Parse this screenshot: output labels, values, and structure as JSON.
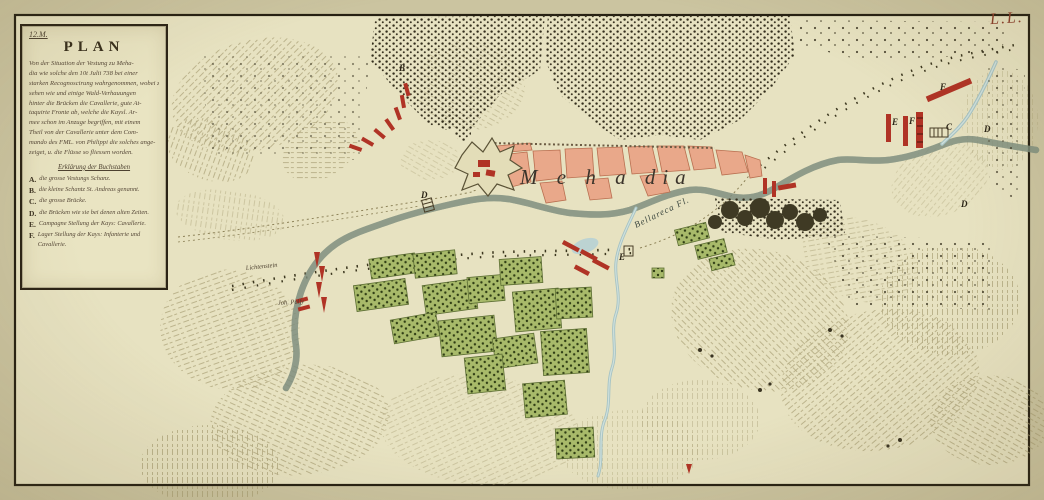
{
  "frame": {
    "corner_mark": "L.L."
  },
  "cartouche": {
    "catalog": "12.M.",
    "title": "PLAN",
    "body_lines": [
      "Von der Situation der Vestung zu Meha-",
      "dia wie solche den 10t Julii 738 bei einer",
      "starken Recognoscirung wahrgenommen, wobei zu",
      "sehen wie und einige Wald-Verhauungen",
      "hinter die Brücken die Cavallerie, gute At-",
      "taquirte Fronte ab, welche die Kaysl. Ar-",
      "mee schon im Anzuge begriffen, mit einem",
      "Theil von der Cavallerie unter dem Com-",
      "mando des FML. von Philippi die solches ange-",
      "zeiget, u. die Flüsse so fliessen worden."
    ],
    "legend_heading": "Erklärung der Buchstaben",
    "legend": [
      {
        "key": "A.",
        "text": "die grosse Vestungs Schanz."
      },
      {
        "key": "B.",
        "text": "die kleine Schantz St. Andreas genannt."
      },
      {
        "key": "C.",
        "text": "die grosse Brücke."
      },
      {
        "key": "D.",
        "text": "die Brücken wie sie bei denen alten Zeiten."
      },
      {
        "key": "E.",
        "text": "Campagne Stellung der Kays: Cavallerie."
      },
      {
        "key": "F.",
        "text": "Lager Stellung der Kays: Infanterie und Cavallerie."
      }
    ]
  },
  "map_labels": {
    "town": "M e h a dia",
    "river": "Bellareca Fl.",
    "regiment_1": "Lichtenstein",
    "regiment_2": "Joh. Palfy",
    "letters": [
      {
        "char": "B",
        "x": 399,
        "y": 71
      },
      {
        "char": "D",
        "x": 421,
        "y": 198
      },
      {
        "char": "E",
        "x": 619,
        "y": 260
      },
      {
        "char": "F",
        "x": 940,
        "y": 90
      },
      {
        "char": "E",
        "x": 892,
        "y": 125
      },
      {
        "char": "F",
        "x": 909,
        "y": 124
      },
      {
        "char": "C",
        "x": 946,
        "y": 130
      },
      {
        "char": "D",
        "x": 984,
        "y": 132
      },
      {
        "char": "D",
        "x": 961,
        "y": 207
      }
    ]
  },
  "colors": {
    "paper": "#e7e2c1",
    "margin": "#cbc4a0",
    "frame_ink": "#262012",
    "river": "#a6c3c4",
    "town_fill": "#e9a88a",
    "field_fill": "#a8ba6a",
    "military_red": "#b03325",
    "forest_ink": "#332d1c",
    "corner_mark_red": "#8b3d2a"
  }
}
